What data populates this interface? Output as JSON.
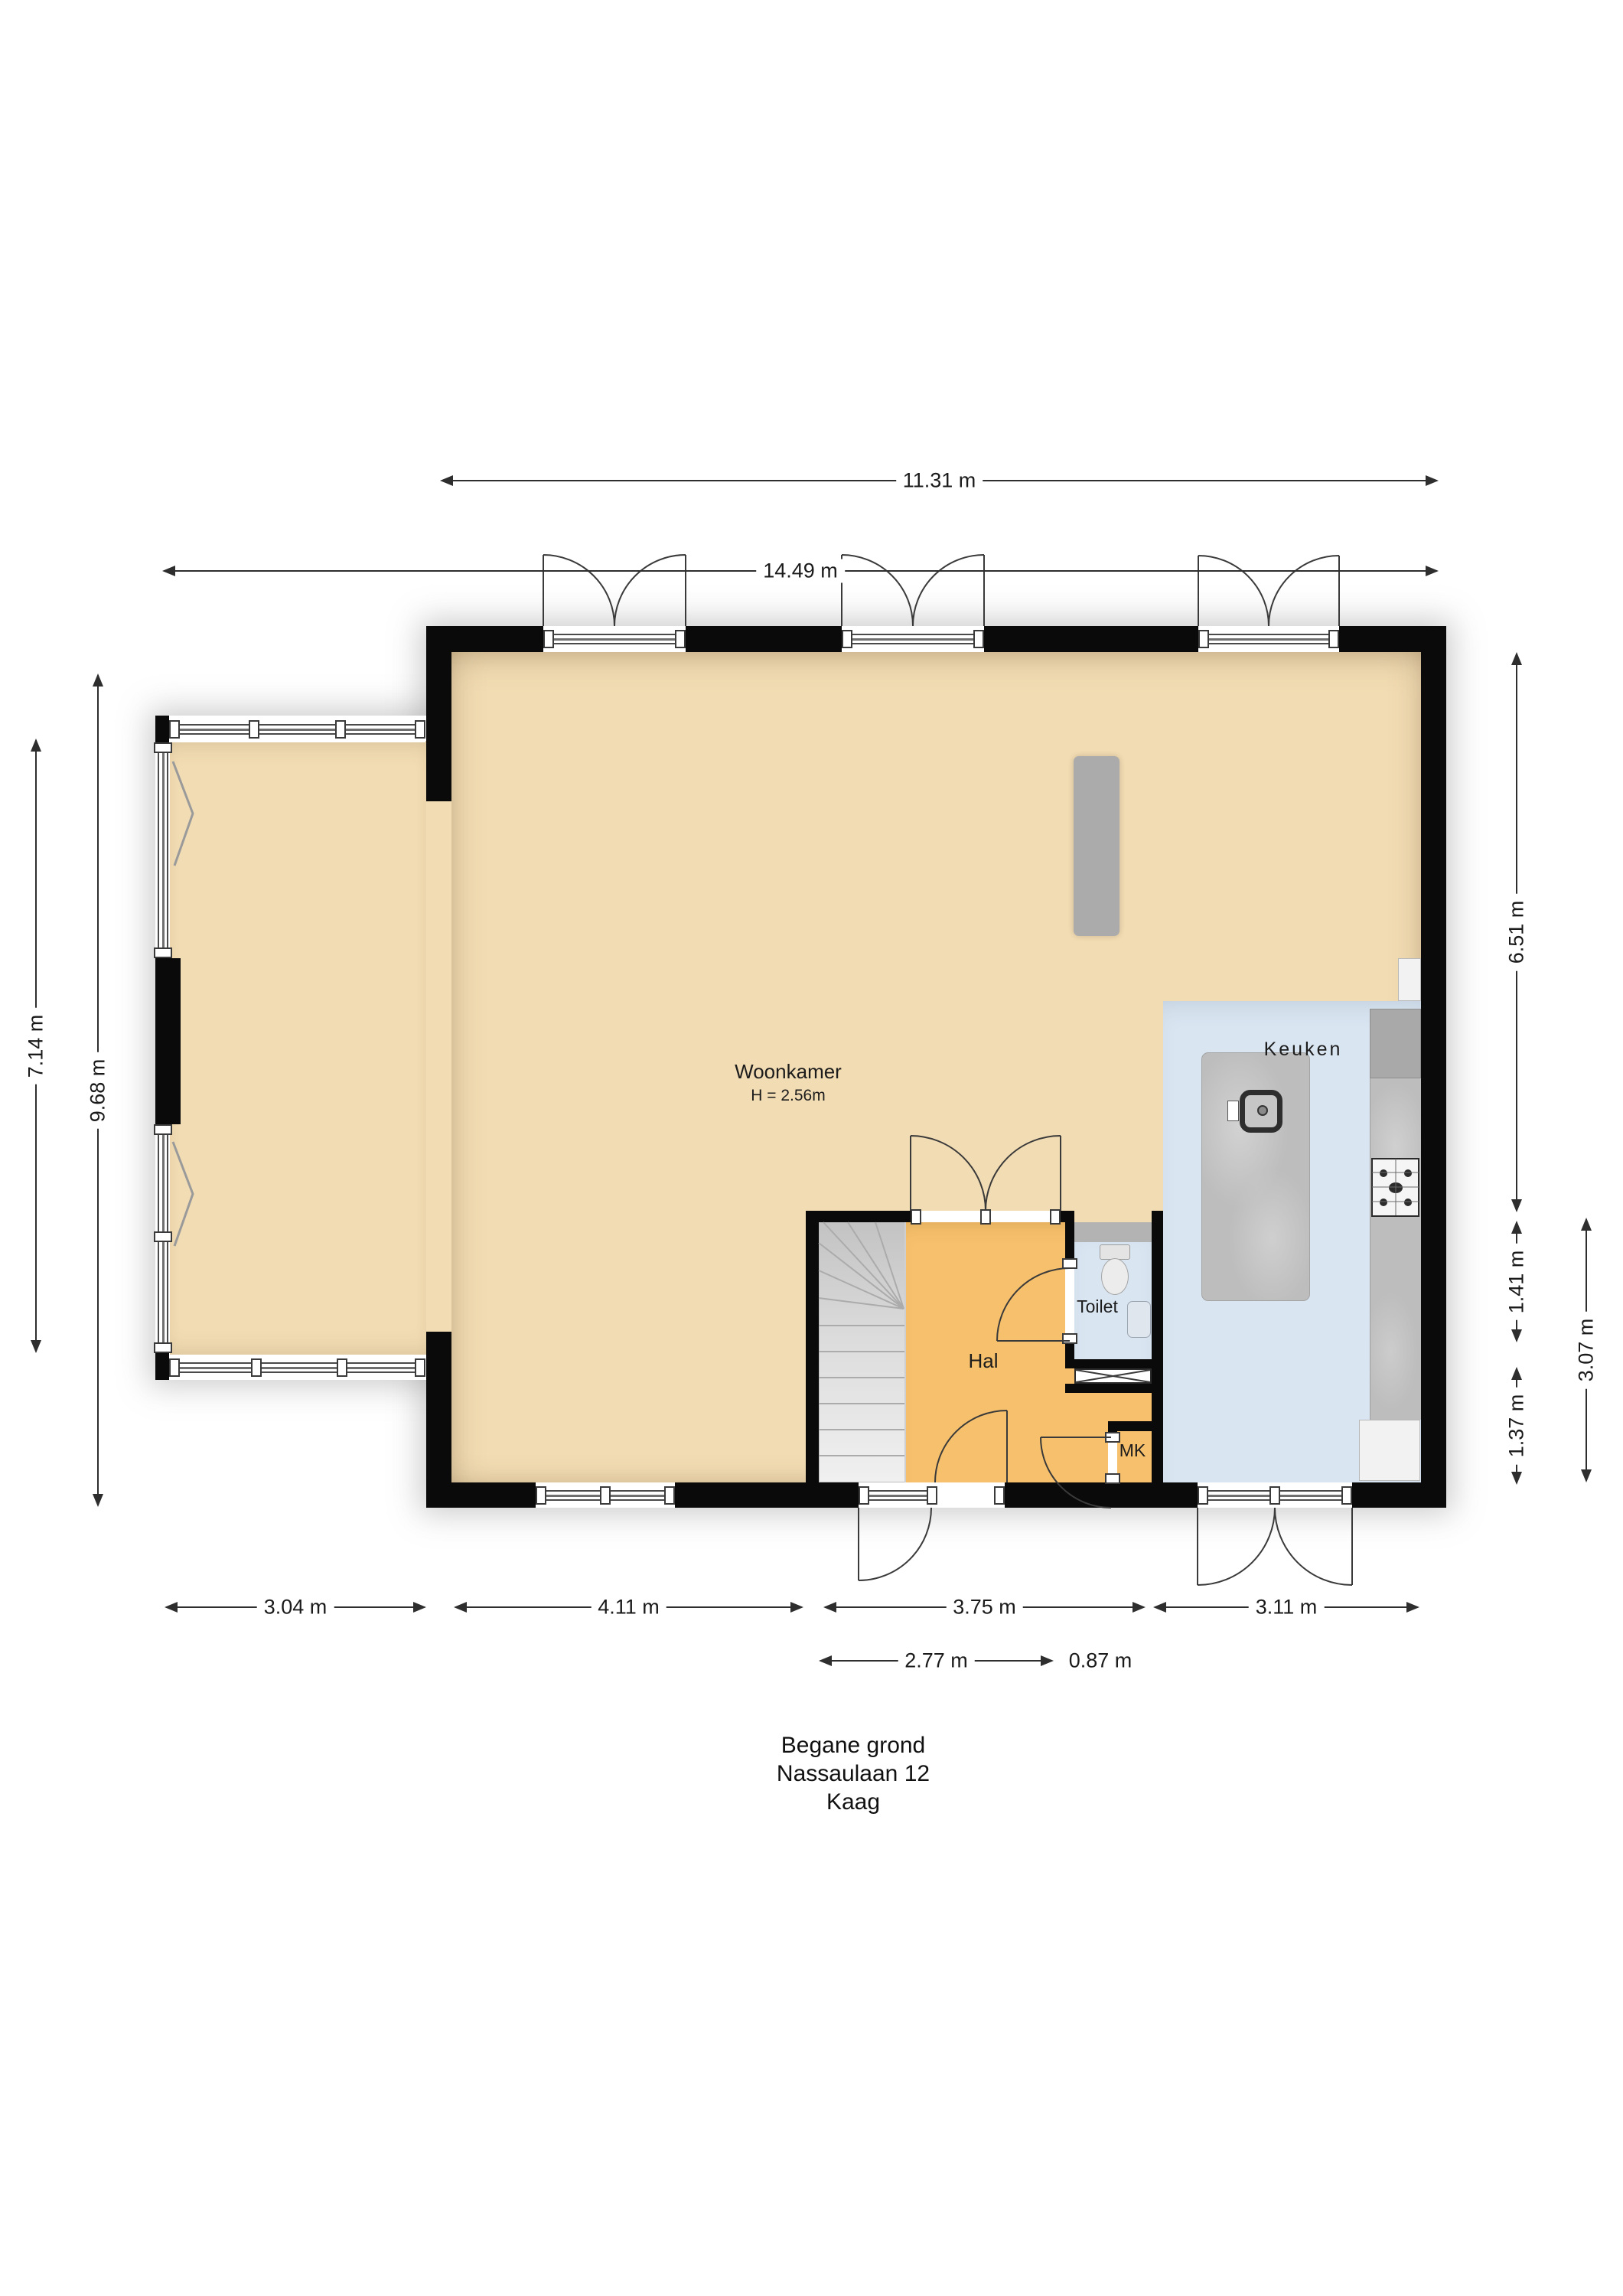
{
  "title": {
    "line1": "Begane grond",
    "line2": "Nassaulaan 12",
    "line3": "Kaag"
  },
  "rooms": {
    "woonkamer": {
      "name": "Woonkamer",
      "ceiling_height": "H = 2.56m"
    },
    "keuken": {
      "name": "Keuken"
    },
    "hal": {
      "name": "Hal"
    },
    "toilet": {
      "name": "Toilet"
    },
    "mk": {
      "name": "MK"
    }
  },
  "dimensions": {
    "top": [
      {
        "label": "11.31 m"
      },
      {
        "label": "14.49 m"
      }
    ],
    "left": [
      {
        "label": "7.14 m"
      },
      {
        "label": "9.68 m"
      }
    ],
    "right": [
      {
        "label": "6.51 m"
      },
      {
        "label": "1.41 m"
      },
      {
        "label": "1.37 m"
      },
      {
        "label": "3.07 m"
      }
    ],
    "bottom": [
      {
        "label": "3.04 m"
      },
      {
        "label": "4.11 m"
      },
      {
        "label": "3.75 m"
      },
      {
        "label": "3.11 m"
      },
      {
        "label": "2.77 m"
      },
      {
        "label": "0.87 m"
      }
    ]
  },
  "colors": {
    "wall": "#0a0a0a",
    "floor_living": "#f2dcb3",
    "floor_hall": "#f6c06c",
    "floor_wet": "#d9e5f1",
    "stairs": "#dcdcdc",
    "counter": "#bdbdbd",
    "cabinet": "#ababab",
    "dimension_line": "#2e2e2e"
  }
}
